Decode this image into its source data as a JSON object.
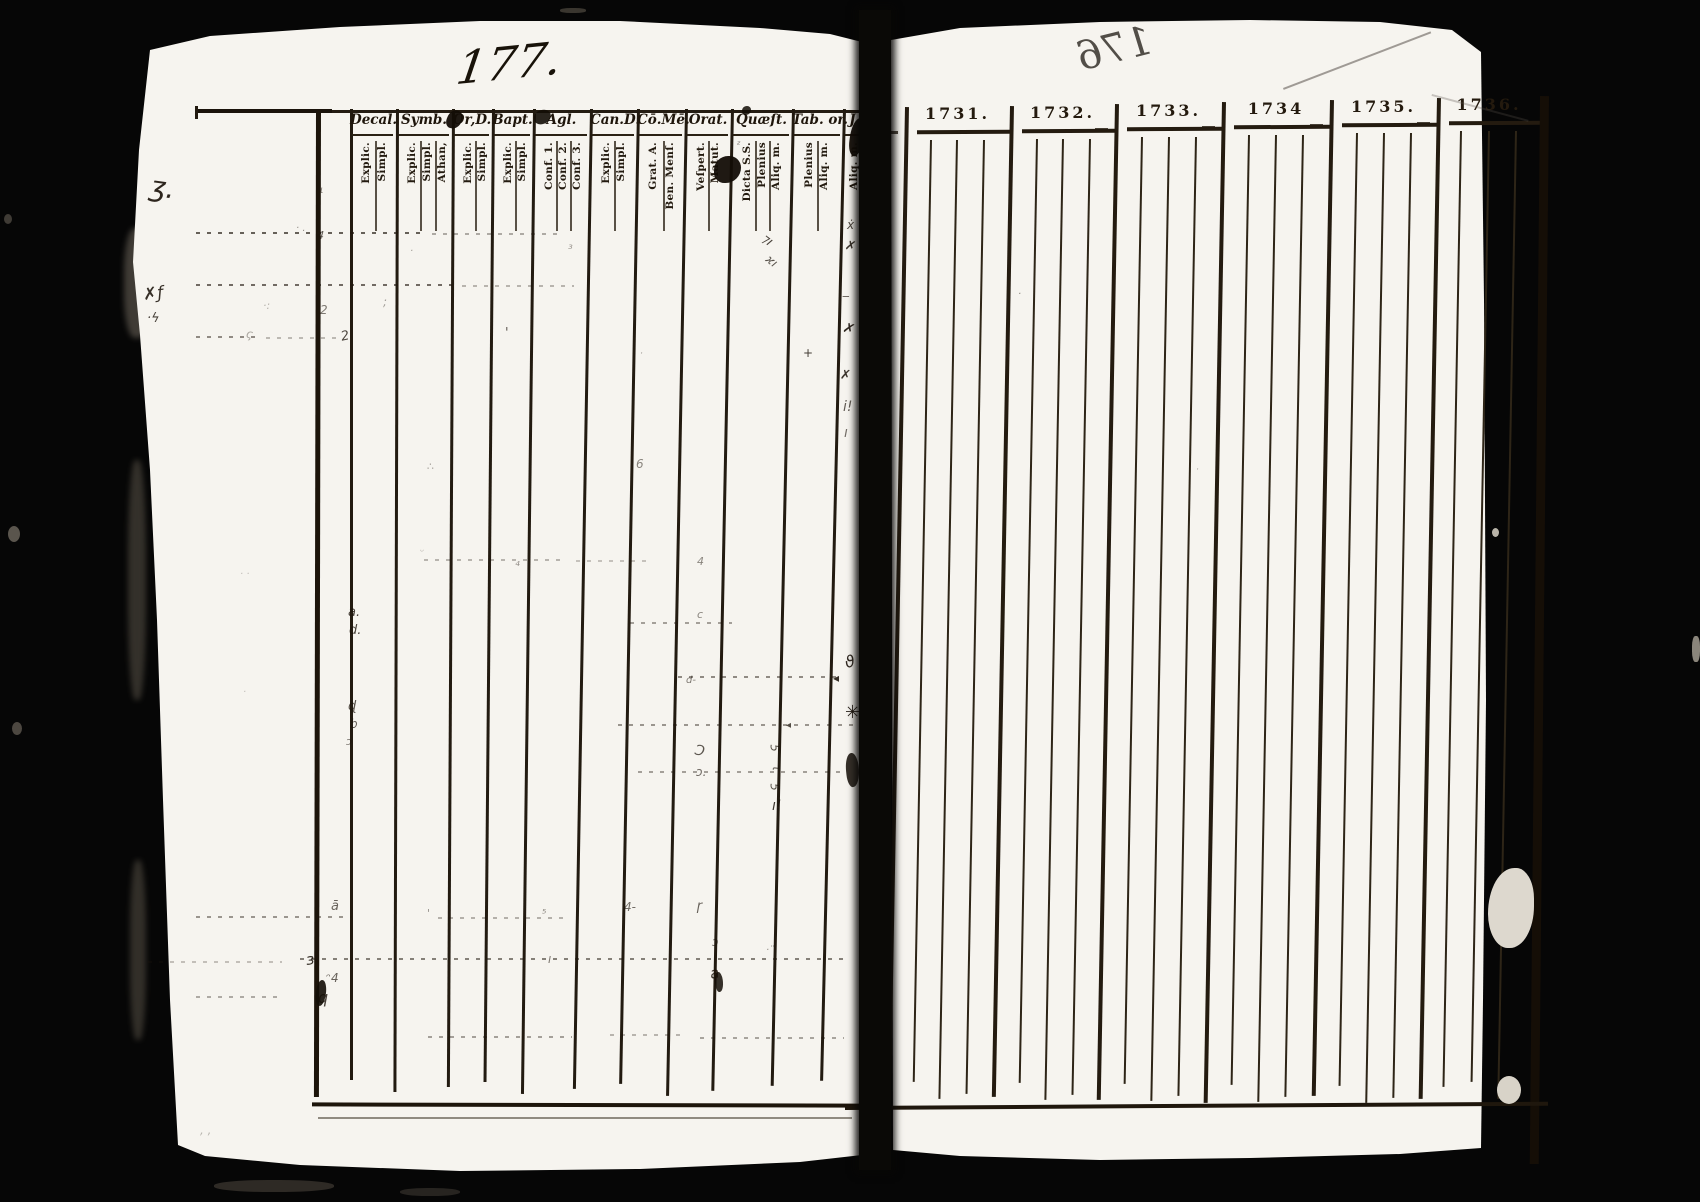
{
  "scan": {
    "paper_color": "#f6f4ef",
    "ink_color": "#1c140c",
    "background_color": "#060606",
    "edge_fibers": [
      {
        "x": 124,
        "y": 228,
        "w": 26,
        "h": 110,
        "c": "#4a453e"
      },
      {
        "x": 128,
        "y": 460,
        "w": 18,
        "h": 240,
        "c": "#3c3831"
      },
      {
        "x": 130,
        "y": 860,
        "w": 16,
        "h": 180,
        "c": "#3a362f"
      }
    ],
    "specks": [
      {
        "x": 1488,
        "y": 868,
        "w": 46,
        "h": 80,
        "c": "#ddd8ce",
        "br": "60% 40% 55% 45%"
      },
      {
        "x": 1497,
        "y": 1076,
        "w": 24,
        "h": 28,
        "c": "#d8d3c8",
        "br": "50%"
      },
      {
        "x": 1492,
        "y": 528,
        "w": 7,
        "h": 9,
        "c": "#b9b4a9",
        "br": "50%"
      },
      {
        "x": 8,
        "y": 526,
        "w": 12,
        "h": 16,
        "c": "#5a554d",
        "br": "50%"
      },
      {
        "x": 12,
        "y": 722,
        "w": 10,
        "h": 13,
        "c": "#4c4740",
        "br": "50%"
      },
      {
        "x": 4,
        "y": 214,
        "w": 8,
        "h": 10,
        "c": "#3f3b35",
        "br": "50%"
      },
      {
        "x": 560,
        "y": 8,
        "w": 26,
        "h": 5,
        "c": "#3a362f",
        "br": "40%"
      },
      {
        "x": 214,
        "y": 1180,
        "w": 120,
        "h": 12,
        "c": "#2e2a25",
        "br": "45%"
      },
      {
        "x": 400,
        "y": 1188,
        "w": 60,
        "h": 8,
        "c": "#272420",
        "br": "45%"
      },
      {
        "x": 1692,
        "y": 636,
        "w": 8,
        "h": 26,
        "c": "#8a857b",
        "br": "40%"
      }
    ]
  },
  "left_page": {
    "page_number": "177.",
    "column_groups": [
      {
        "header": "Decal.",
        "x": 350,
        "w": 46,
        "subs": [
          {
            "label": "Explic.",
            "lx": 361
          },
          {
            "label": "Simpl.",
            "lx": 377
          }
        ]
      },
      {
        "header": "Symb.",
        "x": 396,
        "w": 56,
        "subs": [
          {
            "label": "Explic.",
            "lx": 407
          },
          {
            "label": "Simpl.",
            "lx": 422
          },
          {
            "label": "Athan,",
            "lx": 437
          }
        ]
      },
      {
        "header": "Or,D.",
        "x": 452,
        "w": 40,
        "subs": [
          {
            "label": "Explic.",
            "lx": 463
          },
          {
            "label": "Simpl.",
            "lx": 477
          }
        ]
      },
      {
        "header": "Bapt.",
        "x": 492,
        "w": 41,
        "subs": [
          {
            "label": "Explic.",
            "lx": 503
          },
          {
            "label": "Simpl.",
            "lx": 517
          }
        ]
      },
      {
        "header": "Agl.",
        "x": 533,
        "w": 57,
        "subs": [
          {
            "label": "Conf. 1.",
            "lx": 544
          },
          {
            "label": "Conf. 2.",
            "lx": 558
          },
          {
            "label": "Conf. 3.",
            "lx": 572
          }
        ]
      },
      {
        "header": "Can.D.",
        "x": 590,
        "w": 47,
        "subs": [
          {
            "label": "Explic.",
            "lx": 601
          },
          {
            "label": "Simpl.",
            "lx": 616
          }
        ]
      },
      {
        "header": "Cō.Mē.",
        "x": 637,
        "w": 48,
        "subs": [
          {
            "label": "Grat. A.",
            "lx": 648
          },
          {
            "label": "Ben. Menſ.",
            "lx": 665
          }
        ]
      },
      {
        "header": "Orat.",
        "x": 685,
        "w": 46,
        "subs": [
          {
            "label": "Veſpert.",
            "lx": 696
          },
          {
            "label": "Matut.",
            "lx": 710
          }
        ]
      },
      {
        "header": "Quæſt.",
        "x": 731,
        "w": 61,
        "subs": [
          {
            "label": "Dicta S.S.",
            "lx": 742
          },
          {
            "label": "Plenius",
            "lx": 757
          },
          {
            "label": "Aliq. m.",
            "lx": 771
          }
        ]
      },
      {
        "header": "Tab. or.",
        "x": 792,
        "w": 51,
        "subs": [
          {
            "label": "Plenius",
            "lx": 804
          },
          {
            "label": "Aliq. m.",
            "lx": 819
          }
        ]
      },
      {
        "header": "J",
        "x": 843,
        "w": 19,
        "subs": [
          {
            "label": "Aliq. m.",
            "lx": 849
          }
        ]
      }
    ],
    "row_guides": [
      {
        "x1": 196,
        "x2": 424,
        "y": 232,
        "o": 0.7
      },
      {
        "x1": 432,
        "x2": 560,
        "y": 233,
        "o": 0.35
      },
      {
        "x1": 196,
        "x2": 452,
        "y": 284,
        "o": 0.65
      },
      {
        "x1": 462,
        "x2": 574,
        "y": 285,
        "o": 0.3
      },
      {
        "x1": 196,
        "x2": 262,
        "y": 336,
        "o": 0.5
      },
      {
        "x1": 266,
        "x2": 338,
        "y": 337,
        "o": 0.28
      },
      {
        "x1": 424,
        "x2": 562,
        "y": 559,
        "o": 0.3
      },
      {
        "x1": 576,
        "x2": 652,
        "y": 560,
        "o": 0.24
      },
      {
        "x1": 630,
        "x2": 732,
        "y": 622,
        "o": 0.4
      },
      {
        "x1": 678,
        "x2": 838,
        "y": 676,
        "o": 0.5
      },
      {
        "x1": 618,
        "x2": 856,
        "y": 724,
        "o": 0.45
      },
      {
        "x1": 638,
        "x2": 842,
        "y": 771,
        "o": 0.4
      },
      {
        "x1": 196,
        "x2": 352,
        "y": 916,
        "o": 0.45
      },
      {
        "x1": 438,
        "x2": 566,
        "y": 917,
        "o": 0.32
      },
      {
        "x1": 300,
        "x2": 848,
        "y": 958,
        "o": 0.55
      },
      {
        "x1": 148,
        "x2": 282,
        "y": 961,
        "o": 0.25
      },
      {
        "x1": 196,
        "x2": 280,
        "y": 996,
        "o": 0.35
      },
      {
        "x1": 428,
        "x2": 572,
        "y": 1036,
        "o": 0.4
      },
      {
        "x1": 700,
        "x2": 844,
        "y": 1037,
        "o": 0.38
      },
      {
        "x1": 610,
        "x2": 680,
        "y": 1034,
        "o": 0.3
      }
    ],
    "marks": [
      {
        "x": 150,
        "y": 174,
        "t": "ʒ.",
        "s": 28,
        "r": 8,
        "o": 0.92
      },
      {
        "x": 296,
        "y": 224,
        "t": "· .",
        "s": 10,
        "r": 0,
        "o": 0.45
      },
      {
        "x": 263,
        "y": 300,
        "t": "·:",
        "s": 11,
        "r": 0,
        "o": 0.3
      },
      {
        "x": 383,
        "y": 296,
        "t": ";",
        "s": 12,
        "r": 0,
        "o": 0.38
      },
      {
        "x": 410,
        "y": 247,
        "t": "·",
        "s": 10,
        "r": 0,
        "o": 0.4
      },
      {
        "x": 143,
        "y": 286,
        "t": "✗ƒ",
        "s": 17,
        "r": -6,
        "o": 0.88
      },
      {
        "x": 147,
        "y": 312,
        "t": "·ϟ",
        "s": 13,
        "r": 0,
        "o": 0.8
      },
      {
        "x": 246,
        "y": 328,
        "t": "ς",
        "s": 12,
        "r": 10,
        "o": 0.34
      },
      {
        "x": 320,
        "y": 186,
        "t": "ι",
        "s": 10,
        "r": 0,
        "o": 0.55
      },
      {
        "x": 317,
        "y": 230,
        "t": "4",
        "s": 11,
        "r": 5,
        "o": 0.7
      },
      {
        "x": 320,
        "y": 304,
        "t": "2",
        "s": 12,
        "r": 0,
        "o": 0.55
      },
      {
        "x": 341,
        "y": 330,
        "t": "2",
        "s": 13,
        "r": -12,
        "o": 0.78
      },
      {
        "x": 505,
        "y": 327,
        "t": "'",
        "s": 13,
        "r": 0,
        "o": 0.7
      },
      {
        "x": 568,
        "y": 243,
        "t": "³",
        "s": 12,
        "r": 0,
        "o": 0.4
      },
      {
        "x": 640,
        "y": 350,
        "t": "·",
        "s": 9,
        "r": 0,
        "o": 0.45
      },
      {
        "x": 762,
        "y": 234,
        "t": "⁊ı",
        "s": 13,
        "r": 38,
        "o": 0.8
      },
      {
        "x": 766,
        "y": 255,
        "t": "ϰı",
        "s": 12,
        "r": 38,
        "o": 0.72
      },
      {
        "x": 803,
        "y": 347,
        "t": "+",
        "s": 12,
        "r": 0,
        "o": 0.82
      },
      {
        "x": 847,
        "y": 219,
        "t": "ẋ",
        "s": 12,
        "r": 0,
        "o": 0.78
      },
      {
        "x": 845,
        "y": 240,
        "t": "✗",
        "s": 13,
        "r": 12,
        "o": 0.85
      },
      {
        "x": 842,
        "y": 290,
        "t": "‒",
        "s": 12,
        "r": 0,
        "o": 0.7
      },
      {
        "x": 843,
        "y": 322,
        "t": "✗",
        "s": 14,
        "r": 18,
        "o": 0.9
      },
      {
        "x": 840,
        "y": 369,
        "t": "✗",
        "s": 13,
        "r": 5,
        "o": 0.85
      },
      {
        "x": 843,
        "y": 400,
        "t": "i!",
        "s": 14,
        "r": 0,
        "o": 0.68
      },
      {
        "x": 844,
        "y": 426,
        "t": "ı",
        "s": 14,
        "r": 0,
        "o": 0.6
      },
      {
        "x": 636,
        "y": 458,
        "t": "6",
        "s": 12,
        "r": 0,
        "o": 0.5
      },
      {
        "x": 427,
        "y": 461,
        "t": "∴",
        "s": 11,
        "r": 0,
        "o": 0.38
      },
      {
        "x": 515,
        "y": 556,
        "t": "₄",
        "s": 12,
        "r": 0,
        "o": 0.45
      },
      {
        "x": 697,
        "y": 556,
        "t": "4",
        "s": 11,
        "r": 0,
        "o": 0.5
      },
      {
        "x": 348,
        "y": 606,
        "t": "a.",
        "s": 13,
        "r": 0,
        "o": 0.8
      },
      {
        "x": 349,
        "y": 624,
        "t": "d.",
        "s": 13,
        "r": 0,
        "o": 0.78
      },
      {
        "x": 697,
        "y": 609,
        "t": "c",
        "s": 11,
        "r": 0,
        "o": 0.5
      },
      {
        "x": 686,
        "y": 676,
        "t": "d‑",
        "s": 10,
        "r": 0,
        "o": 0.55
      },
      {
        "x": 833,
        "y": 672,
        "t": "◂",
        "s": 12,
        "r": 0,
        "o": 0.88
      },
      {
        "x": 845,
        "y": 654,
        "t": "ϑ",
        "s": 16,
        "r": -15,
        "o": 0.9
      },
      {
        "x": 845,
        "y": 704,
        "t": "✳",
        "s": 18,
        "r": 0,
        "o": 0.95
      },
      {
        "x": 786,
        "y": 721,
        "t": "◂",
        "s": 10,
        "r": 0,
        "o": 0.75
      },
      {
        "x": 694,
        "y": 744,
        "t": "Ɔ",
        "s": 14,
        "r": 10,
        "o": 0.7
      },
      {
        "x": 696,
        "y": 766,
        "t": "ɔ.",
        "s": 12,
        "r": 0,
        "o": 0.62
      },
      {
        "x": 771,
        "y": 742,
        "t": "5",
        "s": 12,
        "r": 85,
        "o": 0.72
      },
      {
        "x": 773,
        "y": 762,
        "t": "τ",
        "s": 12,
        "r": 85,
        "o": 0.68
      },
      {
        "x": 771,
        "y": 781,
        "t": "5",
        "s": 12,
        "r": 85,
        "o": 0.72
      },
      {
        "x": 772,
        "y": 799,
        "t": "ı!",
        "s": 14,
        "r": 0,
        "o": 0.85
      },
      {
        "x": 348,
        "y": 700,
        "t": "ɖ",
        "s": 13,
        "r": 0,
        "o": 0.72
      },
      {
        "x": 350,
        "y": 718,
        "t": "b",
        "s": 12,
        "r": 0,
        "o": 0.66
      },
      {
        "x": 346,
        "y": 736,
        "t": "ↄ",
        "s": 11,
        "r": 0,
        "o": 0.55
      },
      {
        "x": 331,
        "y": 900,
        "t": "ā",
        "s": 13,
        "r": 0,
        "o": 0.65
      },
      {
        "x": 427,
        "y": 908,
        "t": "'",
        "s": 11,
        "r": 0,
        "o": 0.45
      },
      {
        "x": 542,
        "y": 908,
        "t": "⁵",
        "s": 11,
        "r": 0,
        "o": 0.5
      },
      {
        "x": 624,
        "y": 901,
        "t": "4‑",
        "s": 12,
        "r": 0,
        "o": 0.6
      },
      {
        "x": 697,
        "y": 900,
        "t": "ɼ",
        "s": 13,
        "r": 0,
        "o": 0.65
      },
      {
        "x": 712,
        "y": 936,
        "t": "ɔ",
        "s": 12,
        "r": 0,
        "o": 0.55
      },
      {
        "x": 306,
        "y": 952,
        "t": "ɜ!",
        "s": 15,
        "r": -8,
        "o": 0.88
      },
      {
        "x": 548,
        "y": 953,
        "t": "ı",
        "s": 12,
        "r": 0,
        "o": 0.55
      },
      {
        "x": 710,
        "y": 966,
        "t": "a",
        "s": 15,
        "r": -10,
        "o": 0.85
      },
      {
        "x": 326,
        "y": 972,
        "t": "ᵔ4",
        "s": 12,
        "r": 0,
        "o": 0.66
      },
      {
        "x": 318,
        "y": 990,
        "t": "q",
        "s": 16,
        "r": 0,
        "o": 0.8
      },
      {
        "x": 766,
        "y": 946,
        "t": "·¨",
        "s": 10,
        "r": 0,
        "o": 0.45
      },
      {
        "x": 200,
        "y": 1124,
        "t": ", ,",
        "s": 12,
        "r": 0,
        "o": 0.28
      },
      {
        "x": 737,
        "y": 141,
        "t": "ᶻ",
        "s": 10,
        "r": 0,
        "o": 0.6
      },
      {
        "x": 240,
        "y": 570,
        "t": "· ·",
        "s": 10,
        "r": 0,
        "o": 0.25
      },
      {
        "x": 243,
        "y": 688,
        "t": "·",
        "s": 10,
        "r": 0,
        "o": 0.25
      },
      {
        "x": 420,
        "y": 548,
        "t": "ᵕ",
        "s": 10,
        "r": 0,
        "o": 0.3
      },
      {
        "x": 1018,
        "y": 290,
        "t": "·",
        "s": 10,
        "r": 0,
        "o": 0.5
      },
      {
        "x": 1196,
        "y": 466,
        "t": "·",
        "s": 9,
        "r": 0,
        "o": 0.4
      }
    ],
    "ink_blobs": [
      {
        "x": 447,
        "y": 110,
        "w": 15,
        "h": 19,
        "r": 20,
        "o": 0.95
      },
      {
        "x": 534,
        "y": 110,
        "w": 17,
        "h": 14,
        "r": -10,
        "o": 0.9
      },
      {
        "x": 714,
        "y": 156,
        "w": 27,
        "h": 27,
        "r": 0,
        "o": 0.95
      },
      {
        "x": 742,
        "y": 106,
        "w": 9,
        "h": 9,
        "r": 0,
        "o": 0.85
      },
      {
        "x": 850,
        "y": 118,
        "w": 15,
        "h": 38,
        "r": 8,
        "o": 0.95
      },
      {
        "x": 846,
        "y": 753,
        "w": 13,
        "h": 34,
        "r": -6,
        "o": 0.85
      },
      {
        "x": 316,
        "y": 980,
        "w": 10,
        "h": 26,
        "r": 4,
        "o": 0.9
      },
      {
        "x": 715,
        "y": 972,
        "w": 8,
        "h": 20,
        "r": -8,
        "o": 0.85
      }
    ]
  },
  "right_page": {
    "show_through_number": "176",
    "year_groups": [
      {
        "label": "1731.",
        "x": 905,
        "w": 105,
        "subs": [
          930,
          956,
          983
        ]
      },
      {
        "label": "1732.",
        "x": 1010,
        "w": 105,
        "subs": [
          1036,
          1062,
          1089
        ]
      },
      {
        "label": "1733.",
        "x": 1115,
        "w": 107,
        "subs": [
          1141,
          1168,
          1195
        ]
      },
      {
        "label": "1734",
        "x": 1222,
        "w": 108,
        "subs": [
          1248,
          1275,
          1302
        ]
      },
      {
        "label": "1735.",
        "x": 1330,
        "w": 107,
        "subs": [
          1356,
          1383,
          1410
        ]
      },
      {
        "label": "1736.",
        "x": 1437,
        "w": 104,
        "subs": [
          1460,
          1488,
          1515
        ]
      }
    ]
  }
}
